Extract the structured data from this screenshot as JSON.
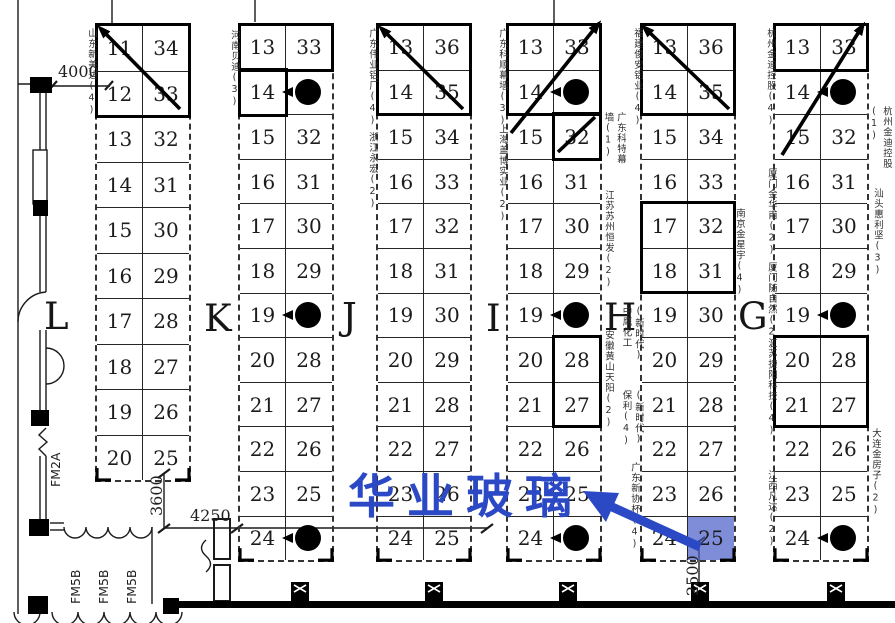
{
  "overlay": {
    "company_name": "华业玻璃",
    "accent_color": "#2b49c5",
    "highlighted_booth": "25"
  },
  "hall_letters": [
    {
      "label": "L",
      "x": 44,
      "y": 295
    },
    {
      "label": "K",
      "x": 204,
      "y": 297
    },
    {
      "label": "J",
      "x": 342,
      "y": 295
    },
    {
      "label": "I",
      "x": 486,
      "y": 297
    },
    {
      "label": "H",
      "x": 604,
      "y": 296
    },
    {
      "label": "G",
      "x": 738,
      "y": 295
    }
  ],
  "columns": [
    {
      "id": "1",
      "x": 97,
      "y": 25,
      "cellH": 45.5,
      "rows": [
        [
          "11",
          "34"
        ],
        [
          "12",
          "33"
        ],
        [
          "13",
          "32"
        ],
        [
          "14",
          "31"
        ],
        [
          "15",
          "30"
        ],
        [
          "16",
          "29"
        ],
        [
          "17",
          "28"
        ],
        [
          "18",
          "27"
        ],
        [
          "19",
          "26"
        ],
        [
          "20",
          "25"
        ]
      ],
      "dots": [],
      "highlight": null,
      "bold_boxes": [
        [
          97,
          25,
          92,
          91
        ]
      ],
      "diagonals": [
        [
          104,
          32,
          180,
          109,
          1
        ]
      ]
    },
    {
      "id": "2",
      "x": 240,
      "y": 25,
      "cellH": 44.6,
      "rows": [
        [
          "13",
          "33"
        ],
        [
          "14",
          ""
        ],
        [
          "15",
          "32"
        ],
        [
          "16",
          "31"
        ],
        [
          "17",
          "30"
        ],
        [
          "18",
          "29"
        ],
        [
          "19",
          ""
        ],
        [
          "20",
          "28"
        ],
        [
          "21",
          "27"
        ],
        [
          "22",
          "26"
        ],
        [
          "23",
          "25"
        ],
        [
          "24",
          ""
        ]
      ],
      "dots": [
        1,
        6,
        11
      ],
      "highlight": null,
      "bold_boxes": [
        [
          240,
          25,
          92,
          45
        ],
        [
          240,
          70,
          46,
          45
        ]
      ],
      "diagonals": []
    },
    {
      "id": "3",
      "x": 378,
      "y": 25,
      "cellH": 44.6,
      "rows": [
        [
          "13",
          "36"
        ],
        [
          "14",
          "35"
        ],
        [
          "15",
          "34"
        ],
        [
          "16",
          "33"
        ],
        [
          "17",
          "32"
        ],
        [
          "18",
          "31"
        ],
        [
          "19",
          "30"
        ],
        [
          "20",
          "29"
        ],
        [
          "21",
          "28"
        ],
        [
          "22",
          "27"
        ],
        [
          "23",
          "26"
        ],
        [
          "24",
          "25"
        ]
      ],
      "dots": [],
      "highlight": null,
      "bold_boxes": [
        [
          378,
          25,
          92,
          89
        ]
      ],
      "diagonals": [
        [
          385,
          32,
          463,
          109,
          1
        ]
      ]
    },
    {
      "id": "4",
      "x": 508,
      "y": 25,
      "cellH": 44.6,
      "rows": [
        [
          "13",
          "33"
        ],
        [
          "14",
          ""
        ],
        [
          "15",
          "32"
        ],
        [
          "16",
          "31"
        ],
        [
          "17",
          "30"
        ],
        [
          "18",
          "29"
        ],
        [
          "19",
          ""
        ],
        [
          "20",
          "28"
        ],
        [
          "21",
          "27"
        ],
        [
          "22",
          "26"
        ],
        [
          "23",
          "25"
        ],
        [
          "24",
          ""
        ]
      ],
      "dots": [
        1,
        6,
        11
      ],
      "highlight": null,
      "bold_boxes": [
        [
          508,
          25,
          92,
          89
        ],
        [
          554,
          114,
          46,
          45
        ],
        [
          554,
          337,
          46,
          89
        ]
      ],
      "diagonals": [
        [
          511,
          133,
          595,
          28,
          2
        ],
        [
          558,
          152,
          595,
          117,
          0
        ]
      ]
    },
    {
      "id": "5",
      "x": 642,
      "y": 25,
      "cellH": 44.6,
      "rows": [
        [
          "13",
          "36"
        ],
        [
          "14",
          "35"
        ],
        [
          "15",
          "34"
        ],
        [
          "16",
          "33"
        ],
        [
          "17",
          "32"
        ],
        [
          "18",
          "31"
        ],
        [
          "19",
          "30"
        ],
        [
          "20",
          "29"
        ],
        [
          "21",
          "28"
        ],
        [
          "22",
          "27"
        ],
        [
          "23",
          "26"
        ],
        [
          "24",
          "25"
        ]
      ],
      "dots": [],
      "highlight": {
        "row": 11,
        "side": "r"
      },
      "bold_boxes": [
        [
          642,
          25,
          92,
          89
        ],
        [
          642,
          203,
          92,
          89
        ]
      ],
      "diagonals": [
        [
          648,
          31,
          729,
          109,
          1
        ]
      ]
    },
    {
      "id": "6",
      "x": 775,
      "y": 25,
      "cellH": 44.6,
      "rows": [
        [
          "13",
          "33"
        ],
        [
          "14",
          ""
        ],
        [
          "15",
          "32"
        ],
        [
          "16",
          "31"
        ],
        [
          "17",
          "30"
        ],
        [
          "18",
          "29"
        ],
        [
          "19",
          ""
        ],
        [
          "20",
          "28"
        ],
        [
          "21",
          "27"
        ],
        [
          "22",
          "26"
        ],
        [
          "23",
          "25"
        ],
        [
          "24",
          ""
        ]
      ],
      "dots": [
        1,
        6,
        11
      ],
      "highlight": null,
      "bold_boxes": [
        [
          775,
          25,
          92,
          45
        ],
        [
          775,
          337,
          92,
          89
        ]
      ],
      "diagonals": [
        [
          860,
          30,
          782,
          155,
          1
        ]
      ]
    }
  ],
  "company_labels": [
    {
      "text": "山东新美达(4)",
      "x": 83,
      "y": 28,
      "h": 112
    },
    {
      "text": "河南贝迪(3)",
      "x": 226,
      "y": 30,
      "h": 95
    },
    {
      "text": "广东伟业铝厂(4)",
      "x": 364,
      "y": 28,
      "h": 120
    },
    {
      "text": "浙江永宏(2)",
      "x": 364,
      "y": 132,
      "h": 88
    },
    {
      "text": "广东科顺幕墙(3)",
      "x": 494,
      "y": 28,
      "h": 115
    },
    {
      "text": "上海盖博实业(2)",
      "x": 494,
      "y": 124,
      "h": 100
    },
    {
      "text": "广东科特幕墙(1)",
      "x": 600,
      "y": 112,
      "h": 62,
      "w": 26
    },
    {
      "text": "江苏苏州恒发(2)",
      "x": 600,
      "y": 190,
      "h": 102
    },
    {
      "text": "安徽黄山天阳(2)",
      "x": 600,
      "y": 330,
      "h": 102
    },
    {
      "text": "福建俊安铝业(4)",
      "x": 629,
      "y": 28,
      "h": 112
    },
    {
      "text": "(新时代)中鹰化工(1)",
      "x": 618,
      "y": 306,
      "h": 64,
      "w": 26
    },
    {
      "text": "(新时代)保利(4)",
      "x": 618,
      "y": 390,
      "h": 60,
      "w": 26
    },
    {
      "text": "广东新协杯(4)",
      "x": 626,
      "y": 462,
      "h": 92
    },
    {
      "text": "南京金星宇(4)",
      "x": 731,
      "y": 208,
      "h": 92
    },
    {
      "text": "杭州金迪控股(4)",
      "x": 762,
      "y": 28,
      "h": 112
    },
    {
      "text": "厦门金华甫(2)",
      "x": 763,
      "y": 168,
      "h": 92
    },
    {
      "text": "厦门随自然(2)",
      "x": 763,
      "y": 262,
      "h": 92
    },
    {
      "text": "江苏捷阳科技(4)",
      "x": 763,
      "y": 338,
      "h": 102
    },
    {
      "text": "江西凡达(2)",
      "x": 763,
      "y": 470,
      "h": 85
    },
    {
      "text": "杭州金迪控股(1)",
      "x": 866,
      "y": 106,
      "h": 64,
      "w": 26
    },
    {
      "text": "汕头惠利坚(3)",
      "x": 869,
      "y": 188,
      "h": 100
    },
    {
      "text": "大连金房子(2)",
      "x": 867,
      "y": 428,
      "h": 100
    }
  ],
  "dimensions": [
    {
      "text": "4000",
      "x": 58,
      "y": 62,
      "vertical": false
    },
    {
      "text": "3600",
      "x": 147,
      "y": 516,
      "vertical": true
    },
    {
      "text": "4250",
      "x": 190,
      "y": 506,
      "vertical": false
    },
    {
      "text": "2500",
      "x": 683,
      "y": 596,
      "vertical": true
    }
  ],
  "door_labels": [
    {
      "text": "FM2A",
      "x": 48,
      "y": 487
    },
    {
      "text": "FM5B",
      "x": 68,
      "y": 604
    },
    {
      "text": "FM5B",
      "x": 96,
      "y": 604
    },
    {
      "text": "FM5B",
      "x": 124,
      "y": 604
    }
  ]
}
